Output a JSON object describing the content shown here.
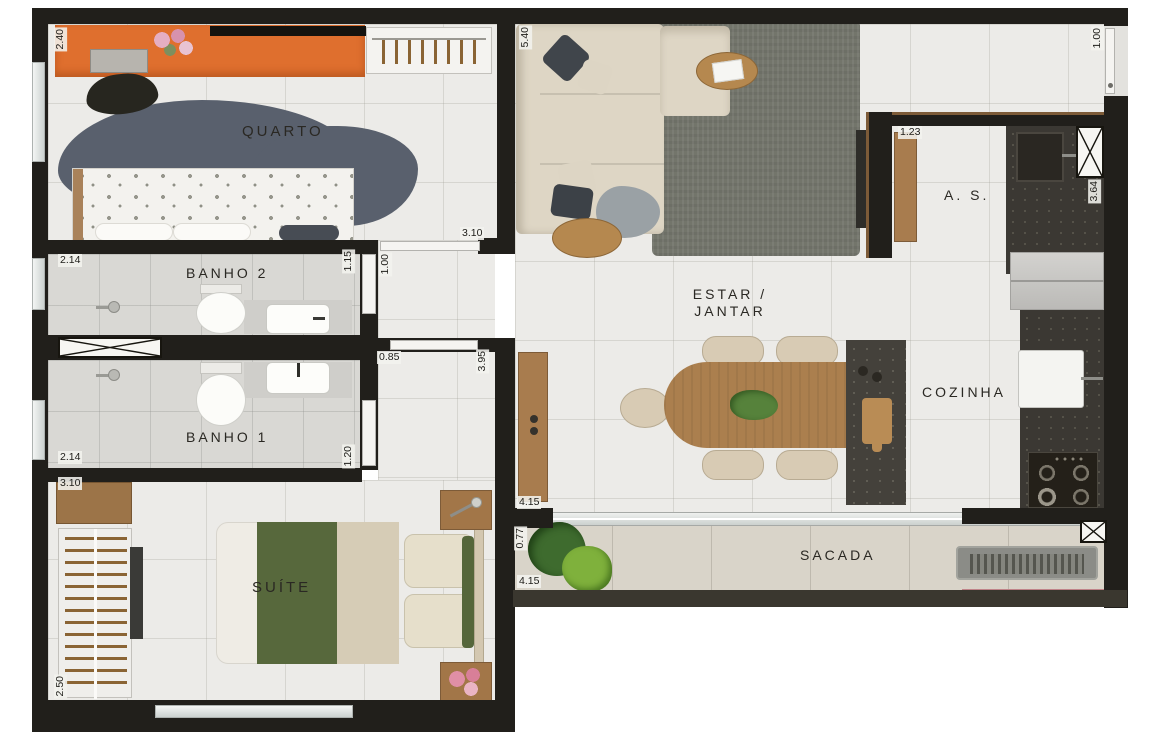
{
  "plan": {
    "type": "apartment-floor-plan"
  },
  "rooms": {
    "quarto": {
      "label": "QUARTO"
    },
    "banho2": {
      "label": "BANHO 2"
    },
    "banho1": {
      "label": "BANHO 1"
    },
    "suite": {
      "label": "SUÍTE"
    },
    "estar_jantar": {
      "label_line1": "ESTAR  /",
      "label_line2": "JANTAR"
    },
    "cozinha": {
      "label": "COZINHA"
    },
    "area_servico": {
      "label": "A. S."
    },
    "sacada": {
      "label": "SACADA"
    }
  },
  "dimensions": {
    "quarto_width": "2.40",
    "quarto_door": "3.10",
    "banho2_width": "2.14",
    "banho2_door": "1.15",
    "hall_width": "1.00",
    "suite_hall_door": "0.85",
    "hall_length": "3.95",
    "banho1_width": "2.14",
    "banho1_door": "1.20",
    "suite_wardrobe": "3.10",
    "suite_width": "2.50",
    "living_length": "5.40",
    "entry_door": "1.00",
    "as_bench": "1.23",
    "kitchen_length": "3.64",
    "living_width": "4.15",
    "sacada_depth": "0.77",
    "sacada_length": "4.15"
  },
  "icons": {
    "shaft_x": "crossed-box X",
    "shower_head": "circle with arm",
    "lamp": "metal dot with stem",
    "faucet": "short dark bar",
    "stove_burners": "four rings"
  },
  "colors": {
    "wall": "#211f1b",
    "floor_main": "#ecebe8",
    "floor_bath": "#d9d8d4",
    "floor_balcony": "#d9d4c9",
    "desk_orange": "#df6f2e",
    "rug_bedroom": "#59606d",
    "rug_living": "#73756b",
    "sofa_cream": "#ded6c5",
    "wood": "#ab7f4e",
    "counter_dark": "#3b3833",
    "blanket_green": "#57683c",
    "mat_pink": "#c08489"
  }
}
